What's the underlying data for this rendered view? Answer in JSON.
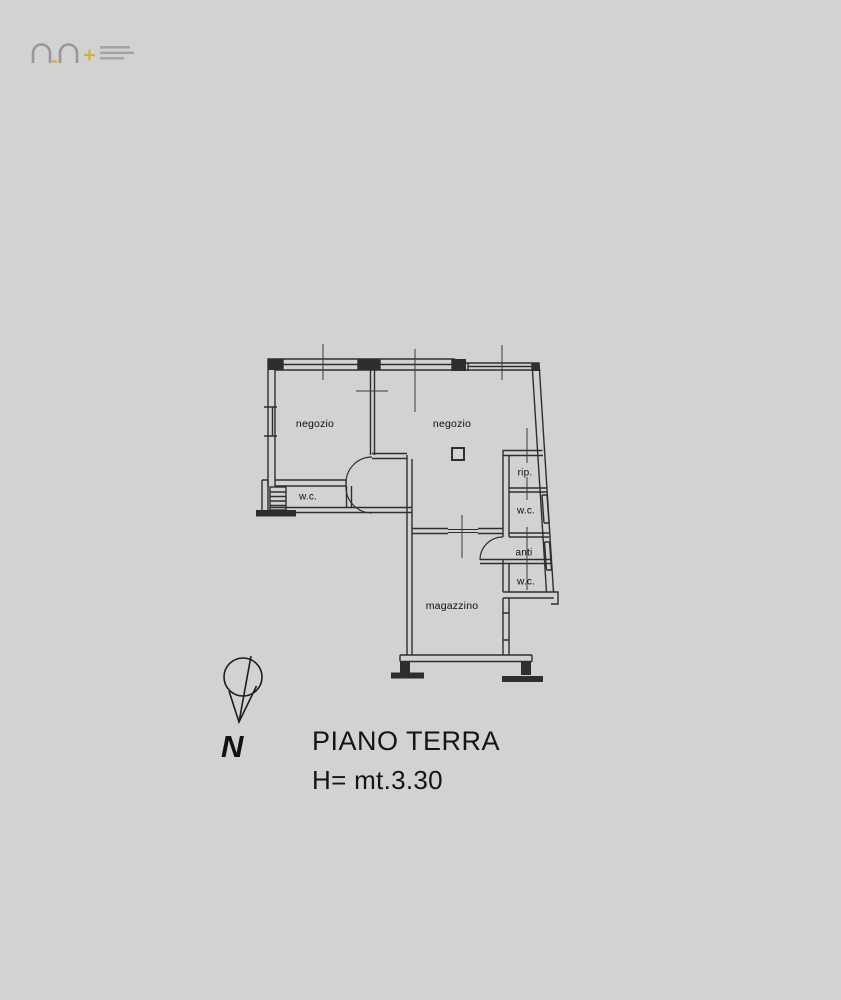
{
  "page": {
    "background_color": "#d2d2d2",
    "line_color": "#2e2e2e"
  },
  "logo": {
    "name": "agency-watermark",
    "arch_color": "#97979b",
    "accent_color": "#d0ad49"
  },
  "plan": {
    "rooms": [
      {
        "id": "negozio-left",
        "label": "negozio"
      },
      {
        "id": "negozio-right",
        "label": "negozio"
      },
      {
        "id": "wc-left",
        "label": "w.c."
      },
      {
        "id": "rip",
        "label": "rip."
      },
      {
        "id": "wc-right-upper",
        "label": "w.c."
      },
      {
        "id": "anti",
        "label": "anti"
      },
      {
        "id": "wc-right-lower",
        "label": "w.c."
      },
      {
        "id": "magazzino",
        "label": "magazzino"
      }
    ],
    "north_label": "N"
  },
  "caption": {
    "floor_title": "PIANO TERRA",
    "height_note": "H= mt.3.30"
  }
}
